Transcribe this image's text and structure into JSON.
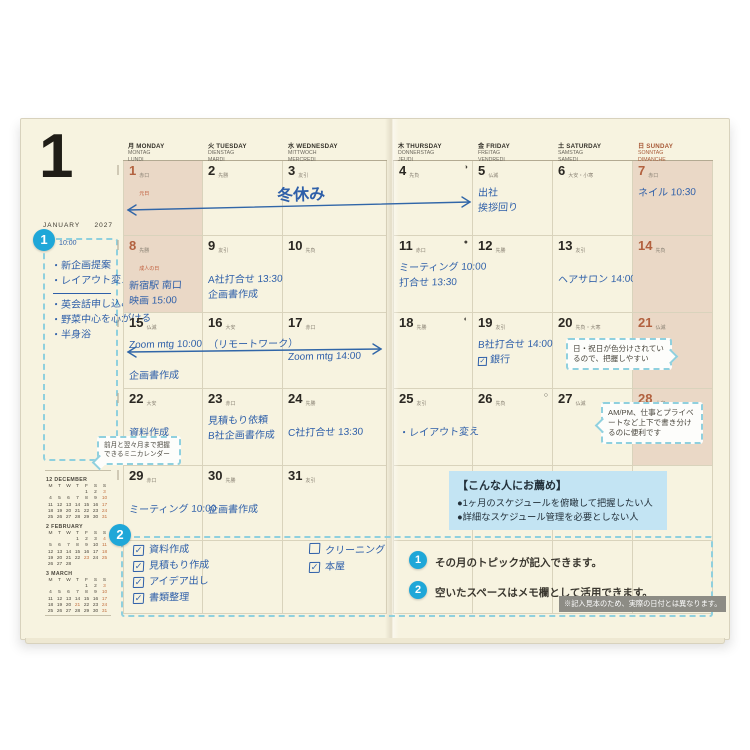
{
  "page": {
    "month_number": "1",
    "month_name": "JANUARY",
    "year": "2027"
  },
  "weekdays": [
    {
      "jp": "月",
      "en": "MONDAY",
      "de": "MONTAG",
      "fr": "LUNDI",
      "sun": false
    },
    {
      "jp": "火",
      "en": "TUESDAY",
      "de": "DIENSTAG",
      "fr": "MARDI",
      "sun": false
    },
    {
      "jp": "水",
      "en": "WEDNESDAY",
      "de": "MITTWOCH",
      "fr": "MERCREDI",
      "sun": false
    },
    {
      "jp": "木",
      "en": "THURSDAY",
      "de": "DONNERSTAG",
      "fr": "JEUDI",
      "sun": false
    },
    {
      "jp": "金",
      "en": "FRIDAY",
      "de": "FREITAG",
      "fr": "VENDREDI",
      "sun": false
    },
    {
      "jp": "土",
      "en": "SATURDAY",
      "de": "SAMSTAG",
      "fr": "SAMEDI",
      "sun": false
    },
    {
      "jp": "日",
      "en": "SUNDAY",
      "de": "SONNTAG",
      "fr": "DIMANCHE",
      "sun": true
    }
  ],
  "days": [
    {
      "d": 1,
      "rokuyo": "赤口",
      "holiday": "元日",
      "shaded": true,
      "red": true,
      "moon": "",
      "lines": []
    },
    {
      "d": 2,
      "rokuyo": "先勝",
      "holiday": "",
      "shaded": false,
      "red": false,
      "moon": "",
      "lines": []
    },
    {
      "d": 3,
      "rokuyo": "友引",
      "holiday": "",
      "shaded": false,
      "red": false,
      "moon": "",
      "lines": []
    },
    {
      "d": 4,
      "rokuyo": "先負",
      "holiday": "",
      "shaded": false,
      "red": false,
      "moon": "◑",
      "lines": []
    },
    {
      "d": 5,
      "rokuyo": "仏滅",
      "holiday": "",
      "shaded": false,
      "red": false,
      "moon": "",
      "lines": [
        {
          "t": "出社"
        },
        {
          "t": "挨拶回り"
        }
      ]
    },
    {
      "d": 6,
      "rokuyo": "大安・小寒",
      "holiday": "",
      "shaded": false,
      "red": false,
      "moon": "",
      "lines": []
    },
    {
      "d": 7,
      "rokuyo": "赤口",
      "holiday": "",
      "shaded": true,
      "red": true,
      "moon": "",
      "lines": [
        {
          "t": "ネイル 10:30"
        }
      ]
    },
    {
      "d": 8,
      "rokuyo": "先勝",
      "holiday": "成人の日",
      "shaded": true,
      "red": true,
      "moon": "",
      "lines": [
        {
          "t": "新宿駅 南口"
        },
        {
          "t": "映画 15:00"
        }
      ]
    },
    {
      "d": 9,
      "rokuyo": "友引",
      "holiday": "",
      "shaded": false,
      "red": false,
      "moon": "",
      "lines": [
        {
          "t": "A社打合せ 13:30",
          "low": true
        },
        {
          "t": "企画書作成"
        }
      ]
    },
    {
      "d": 10,
      "rokuyo": "先負",
      "holiday": "",
      "shaded": false,
      "red": false,
      "moon": "",
      "lines": []
    },
    {
      "d": 11,
      "rokuyo": "赤口",
      "holiday": "",
      "shaded": false,
      "red": false,
      "moon": "●",
      "lines": [
        {
          "t": "ミーティング 10:00"
        },
        {
          "t": "打合せ 13:30"
        }
      ]
    },
    {
      "d": 12,
      "rokuyo": "先勝",
      "holiday": "",
      "shaded": false,
      "red": false,
      "moon": "",
      "lines": []
    },
    {
      "d": 13,
      "rokuyo": "友引",
      "holiday": "",
      "shaded": false,
      "red": false,
      "moon": "",
      "lines": [
        {
          "t": "ヘアサロン 14:00",
          "low": true
        }
      ]
    },
    {
      "d": 14,
      "rokuyo": "先負",
      "holiday": "",
      "shaded": true,
      "red": true,
      "moon": "",
      "lines": []
    },
    {
      "d": 15,
      "rokuyo": "仏滅",
      "holiday": "",
      "shaded": false,
      "red": false,
      "moon": "",
      "lines": [
        {
          "t": "Zoom mtg 10:00"
        },
        {
          "t": "企画書作成",
          "low": true
        }
      ]
    },
    {
      "d": 16,
      "rokuyo": "大安",
      "holiday": "",
      "shaded": false,
      "red": false,
      "moon": "",
      "lines": [
        {
          "t": "（リモートワーク）"
        }
      ]
    },
    {
      "d": 17,
      "rokuyo": "赤口",
      "holiday": "",
      "shaded": false,
      "red": false,
      "moon": "",
      "lines": [
        {
          "t": "Zoom mtg 14:00",
          "low": true
        }
      ]
    },
    {
      "d": 18,
      "rokuyo": "先勝",
      "holiday": "",
      "shaded": false,
      "red": false,
      "moon": "◐",
      "lines": []
    },
    {
      "d": 19,
      "rokuyo": "友引",
      "holiday": "",
      "shaded": false,
      "red": false,
      "moon": "",
      "lines": [
        {
          "t": "B社打合せ 14:00"
        },
        {
          "t": "銀行",
          "check": true
        }
      ]
    },
    {
      "d": 20,
      "rokuyo": "先負・大寒",
      "holiday": "",
      "shaded": false,
      "red": false,
      "moon": "",
      "lines": []
    },
    {
      "d": 21,
      "rokuyo": "仏滅",
      "holiday": "",
      "shaded": true,
      "red": true,
      "moon": "",
      "lines": []
    },
    {
      "d": 22,
      "rokuyo": "大安",
      "holiday": "",
      "shaded": false,
      "red": false,
      "moon": "",
      "lines": [
        {
          "t": "資料作成",
          "low": true
        }
      ]
    },
    {
      "d": 23,
      "rokuyo": "赤口",
      "holiday": "",
      "shaded": false,
      "red": false,
      "moon": "",
      "lines": [
        {
          "t": "見積もり依頼"
        },
        {
          "t": "B社企画書作成"
        }
      ]
    },
    {
      "d": 24,
      "rokuyo": "先勝",
      "holiday": "",
      "shaded": false,
      "red": false,
      "moon": "",
      "lines": [
        {
          "t": "C社打合せ 13:30",
          "low": true
        }
      ]
    },
    {
      "d": 25,
      "rokuyo": "友引",
      "holiday": "",
      "shaded": false,
      "red": false,
      "moon": "",
      "lines": [
        {
          "t": "・レイアウト変え",
          "low": true
        }
      ]
    },
    {
      "d": 26,
      "rokuyo": "先負",
      "holiday": "",
      "shaded": false,
      "red": false,
      "moon": "○",
      "lines": []
    },
    {
      "d": 27,
      "rokuyo": "仏滅",
      "holiday": "",
      "shaded": false,
      "red": false,
      "moon": "",
      "lines": []
    },
    {
      "d": 28,
      "rokuyo": "大安",
      "holiday": "",
      "shaded": true,
      "red": true,
      "moon": "",
      "lines": []
    },
    {
      "d": 29,
      "rokuyo": "赤口",
      "holiday": "",
      "shaded": false,
      "red": false,
      "moon": "",
      "lines": [
        {
          "t": "ミーティング 10:00",
          "low": true
        }
      ]
    },
    {
      "d": 30,
      "rokuyo": "先勝",
      "holiday": "",
      "shaded": false,
      "red": false,
      "moon": "",
      "lines": [
        {
          "t": "企画書作成",
          "low": true
        }
      ]
    },
    {
      "d": 31,
      "rokuyo": "友引",
      "holiday": "",
      "shaded": false,
      "red": false,
      "moon": "",
      "lines": []
    }
  ],
  "handwritten_spans": {
    "week1_label": "冬休み",
    "week1_arrow": "double-arrow Mon1 to Fri5",
    "week3_arrow": "double-arrow Mon15 to Wed17"
  },
  "sidebar": {
    "month": "JANUARY",
    "year": "2027",
    "note_time": "10:00",
    "topics_group1": [
      "・新企画提案",
      "・レイアウト変え"
    ],
    "topics_group2": [
      "・英会話申し込み",
      "・野菜中心を心がける",
      "・半身浴"
    ],
    "mini_calendars": [
      {
        "title": "12 DECEMBER",
        "dow": [
          "M",
          "T",
          "W",
          "T",
          "F",
          "S",
          "S"
        ],
        "weeks": [
          [
            "",
            "",
            "",
            "",
            "1",
            "2",
            "3"
          ],
          [
            "4",
            "5",
            "6",
            "7",
            "8",
            "9",
            "10"
          ],
          [
            "11",
            "12",
            "13",
            "14",
            "15",
            "16",
            "17"
          ],
          [
            "18",
            "19",
            "20",
            "21",
            "22",
            "23",
            "24"
          ],
          [
            "25",
            "26",
            "27",
            "28",
            "29",
            "30",
            "31"
          ]
        ],
        "accent": [
          "3",
          "10",
          "17",
          "24",
          "31"
        ]
      },
      {
        "title": "2 FEBRUARY",
        "dow": [
          "M",
          "T",
          "W",
          "T",
          "F",
          "S",
          "S"
        ],
        "weeks": [
          [
            "",
            "",
            "",
            "1",
            "2",
            "3",
            "4"
          ],
          [
            "5",
            "6",
            "7",
            "8",
            "9",
            "10",
            "11"
          ],
          [
            "12",
            "13",
            "14",
            "15",
            "16",
            "17",
            "18"
          ],
          [
            "19",
            "20",
            "21",
            "22",
            "23",
            "24",
            "25"
          ],
          [
            "26",
            "27",
            "28",
            "",
            "",
            "",
            ""
          ]
        ],
        "accent": [
          "4",
          "11",
          "18",
          "25",
          "23"
        ]
      },
      {
        "title": "3 MARCH",
        "dow": [
          "M",
          "T",
          "W",
          "T",
          "F",
          "S",
          "S"
        ],
        "weeks": [
          [
            "",
            "",
            "",
            "",
            "1",
            "2",
            "3"
          ],
          [
            "4",
            "5",
            "6",
            "7",
            "8",
            "9",
            "10"
          ],
          [
            "11",
            "12",
            "13",
            "14",
            "15",
            "16",
            "17"
          ],
          [
            "18",
            "19",
            "20",
            "21",
            "22",
            "23",
            "24"
          ],
          [
            "25",
            "26",
            "27",
            "28",
            "29",
            "30",
            "31"
          ]
        ],
        "accent": [
          "3",
          "10",
          "17",
          "21",
          "24",
          "31"
        ]
      }
    ]
  },
  "memo": {
    "list1": [
      {
        "checked": true,
        "label": "資料作成"
      },
      {
        "checked": true,
        "label": "見積もり作成"
      },
      {
        "checked": true,
        "label": "アイデア出し"
      },
      {
        "checked": true,
        "label": "書類整理"
      }
    ],
    "list2": [
      {
        "checked": false,
        "label": "クリーニング"
      },
      {
        "checked": true,
        "label": "本屋"
      }
    ]
  },
  "callouts": {
    "minical": "前月と翌々月まで把握できるミニカレンダー",
    "holiday_color": "日・祝日が色分けされているので、把握しやすい",
    "ampm": "AM/PM、仕事とプライベートなど上下で書き分けるのに便利です"
  },
  "recommend": {
    "title": "【こんな人にお薦め】",
    "items": [
      "●1ヶ月のスケジュールを俯瞰して把握したい人",
      "●詳細なスケジュール管理を必要としない人"
    ]
  },
  "legend": [
    {
      "num": "1",
      "text": "その月のトピックが記入できます。"
    },
    {
      "num": "2",
      "text": "空いたスペースはメモ欄として活用できます。"
    }
  ],
  "annotation_badges": {
    "badge1": "1",
    "badge2": "2"
  },
  "footnote": "※記入見本のため、実際の日付とは異なります。",
  "colors": {
    "page": "#f7f3e0",
    "shade": "#ead8c6",
    "ink": "#2e5fa9",
    "holiday_red": "#b2613f",
    "accent_blue": "#1fa7d8",
    "dashed_border": "#8fd0de",
    "info_bg": "#c3e4f3",
    "note_bg": "#8d8c85"
  }
}
